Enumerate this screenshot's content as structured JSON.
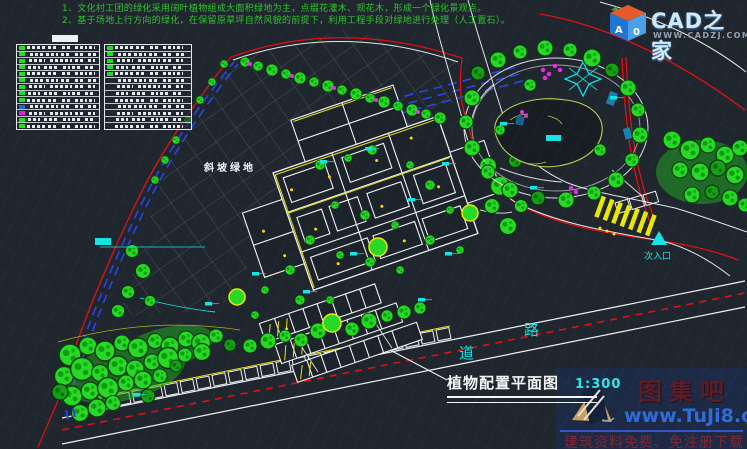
{
  "notes": {
    "line1": "1、文化村工团的绿化采用阔叶植物组成大面积绿地为主，点缀花灌木、观花木，形成一个绿化景观点。",
    "line2": "2、基于场地上行方向的绿化，在保留原草坪自然风貌的前提下，利用工程手段对绿地进行处理（人工置石）。"
  },
  "plan": {
    "slope_label": "斜坡绿地",
    "entrance_label": "次入口",
    "road_label_1": "道",
    "road_label_2": "路",
    "title": "植物配置平面图",
    "scale": "1:300"
  },
  "cadzj": {
    "brand": "CAD之家",
    "site": "WWW.CADZJ.COM",
    "cube_left": "A",
    "cube_right": "0"
  },
  "tuji": {
    "brand": "图集吧",
    "site": "www.TuJi8.com",
    "tagline": "建筑资料免费、免注册下载"
  },
  "palette": {
    "background": "#20262e",
    "boundary_red": "#e01010",
    "tree_green": "#27d827",
    "dark_green": "#14a014",
    "accent_cyan": "#17e3e3",
    "path_yellow": "#e8e800",
    "dash_blue": "#2646ea",
    "hatch_grey": "#4d545e",
    "magenta": "#ea2cea",
    "note_green": "#2cc42c"
  },
  "plant_tables": {
    "rows_left": [
      "g",
      "g",
      "g",
      "g",
      "g",
      "g",
      "g",
      "g",
      "g",
      "b",
      "m",
      "g",
      "g"
    ],
    "rows_right": [
      "g",
      "g",
      "g",
      "g",
      "g",
      "none",
      "none",
      "none",
      "none",
      "none",
      "none",
      "none",
      "none"
    ]
  }
}
